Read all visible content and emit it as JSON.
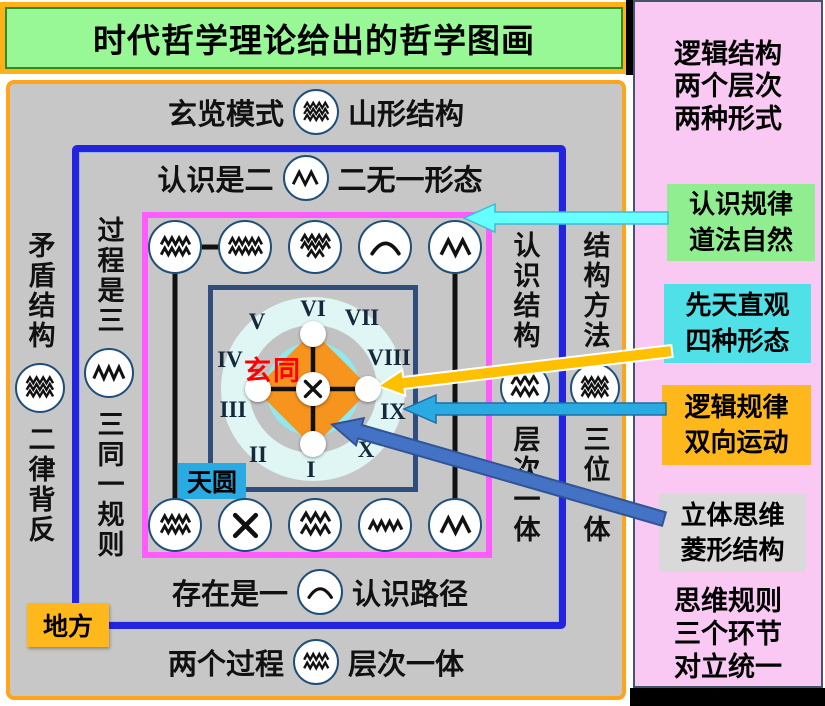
{
  "title": "时代哲学理论给出的哲学图画",
  "sidebar": {
    "heading_lines": [
      "逻辑结构",
      "两个层次",
      "两种形式"
    ],
    "boxes": [
      {
        "lines": [
          "认识规律",
          "道法自然"
        ],
        "bg": "#90EE90"
      },
      {
        "lines": [
          "先天直观",
          "四种形态"
        ],
        "bg": "#4FE0E8"
      },
      {
        "lines": [
          "逻辑规律",
          "双向运动"
        ],
        "bg": "#FFB81C"
      },
      {
        "lines": [
          "立体思维",
          "菱形结构"
        ],
        "bg": "#D9D9D9"
      }
    ],
    "footer_lines": [
      "思维规则",
      "三个环节",
      "对立统一"
    ]
  },
  "main": {
    "row_top_outer": {
      "left": "玄览模式",
      "symbol": "wave3",
      "right": "山形结构"
    },
    "row_top_inner": {
      "left": "认识是二",
      "symbol": "zig2",
      "right": "二无一形态"
    },
    "row_bottom_inner": {
      "left": "存在是一",
      "symbol": "arc",
      "right": "认识路径"
    },
    "row_bottom_outer": {
      "left": "两个过程",
      "symbol": "wave2",
      "right": "层次一体"
    },
    "col_far_left": {
      "top": "矛盾结构",
      "symbol": "wave3",
      "bottom": "二律背反"
    },
    "col_left": {
      "top": "过程是三",
      "symbol": "zig3",
      "bottom": "三同一规则"
    },
    "col_right_inner": {
      "top": "认识结构",
      "symbol": "wave2deep",
      "bottom": "层次一体"
    },
    "col_right_outer": {
      "top": "结构方法",
      "symbol": "wave3",
      "bottom": "三位一体"
    },
    "circle_row_top": [
      "wave2",
      "wave2wide",
      "wave3dense",
      "arc",
      "zig2"
    ],
    "circle_row_bottom": [
      "wave2",
      "cross",
      "wave2deep",
      "zig4small",
      "zig2"
    ],
    "center": {
      "numerals": [
        "I",
        "II",
        "III",
        "IV",
        "V",
        "VI",
        "VII",
        "VIII",
        "IX",
        "X"
      ],
      "label": "玄同",
      "center_symbol": "cross",
      "tag_circle": "天圆",
      "tag_square": "地方"
    }
  },
  "colors": {
    "title_bg": "#98F896",
    "outer_frame": "#FFA41C",
    "blue_frame": "#2424DE",
    "magenta_frame": "#FF5CFF",
    "inner_square": "#2F4E7D",
    "panel_bg": "#C7C7C7",
    "sidebar_bg": "#F9C9F3",
    "diamond": "#F7941E",
    "inner_cyan_ring": "#8FE9EE",
    "arrow_cyan": "#66FFFF",
    "arrow_gold": "#FFC000",
    "arrow_blue": "#29ABE2",
    "arrow_darkblue": "#4472C4",
    "tag_sky_bg": "#29ABE2",
    "tag_earth_bg": "#FFB81C",
    "red_label": "#FF0000"
  }
}
